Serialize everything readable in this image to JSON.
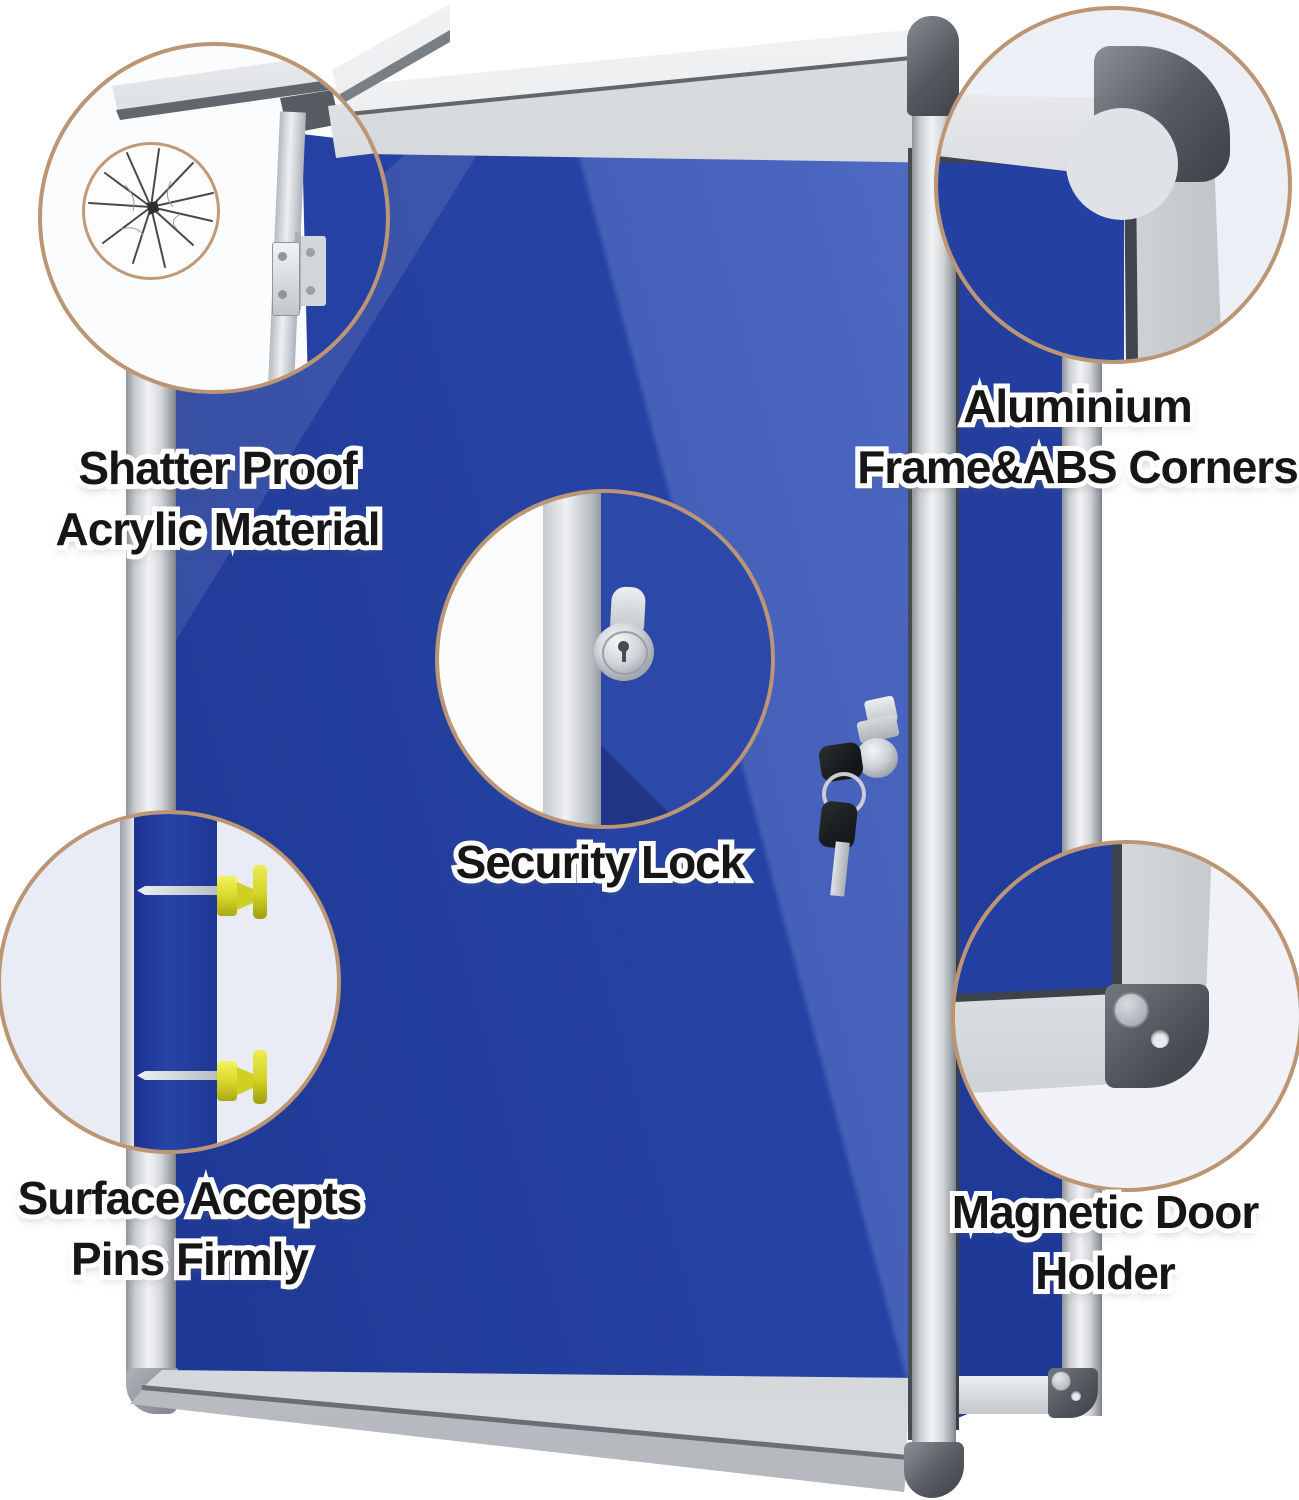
{
  "callouts": [
    {
      "id": "shatter-proof",
      "lines": [
        "Shatter Proof",
        "Acrylic Material"
      ]
    },
    {
      "id": "aluminium-frame",
      "lines": [
        "Aluminium",
        "Frame&ABS Corners"
      ]
    },
    {
      "id": "security-lock",
      "lines": [
        "Security Lock"
      ]
    },
    {
      "id": "surface-pins",
      "lines": [
        "Surface Accepts",
        "Pins Firmly"
      ]
    },
    {
      "id": "magnetic-holder",
      "lines": [
        "Magnetic Door",
        "Holder"
      ]
    }
  ],
  "colors": {
    "background": "#ffffff",
    "felt_blue": "#2642a2",
    "felt_dark_blue": "#1b3490",
    "glare_blue": "#4a65bf",
    "frame_silver": "#d4d7da",
    "abs_corner_dark": "#53585f",
    "circle_border_tan": "#bc9573",
    "pin_yellow": "#e6e63a",
    "key_black": "#1c1e21"
  }
}
